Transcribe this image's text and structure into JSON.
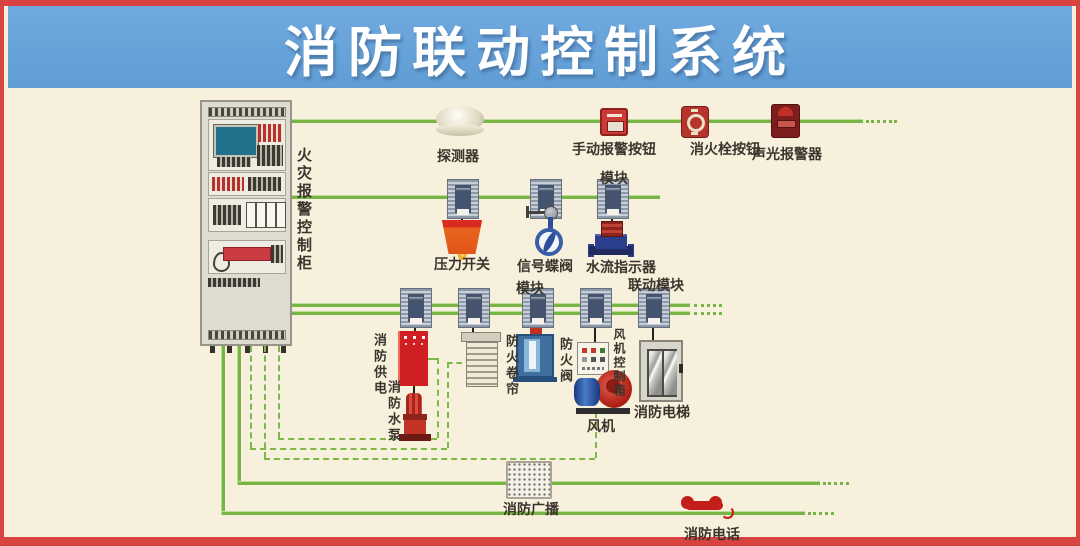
{
  "title": "消防联动控制系统",
  "colors": {
    "background": "#f7f0dc",
    "banner_blue": "#6fa9df",
    "frame_red": "#d9433f",
    "line_green": "#79b544",
    "title_text": "#ffffff",
    "label_text": "#3a342c"
  },
  "cabinet": {
    "label": "火灾报警控制柜"
  },
  "labels": {
    "detector": "探测器",
    "manual_alarm_button": "手动报警按钮",
    "hydrant_button": "消火栓按钮",
    "sound_light_alarm": "声光报警器",
    "module": "模块",
    "pressure_switch": "压力开关",
    "signal_valve": "信号蝶阀",
    "water_flow_indicator": "水流指示器",
    "linkage_module": "联动模块",
    "fire_power": "消防供电",
    "fire_pump": "消防水泵",
    "fire_shutter": "防火卷帘",
    "fire_damper": "防火阀",
    "fan_control_box": "风机控制箱",
    "fan": "风机",
    "fire_elevator": "消防电梯",
    "fire_broadcast": "消防广播",
    "fire_telephone": "消防电话"
  }
}
